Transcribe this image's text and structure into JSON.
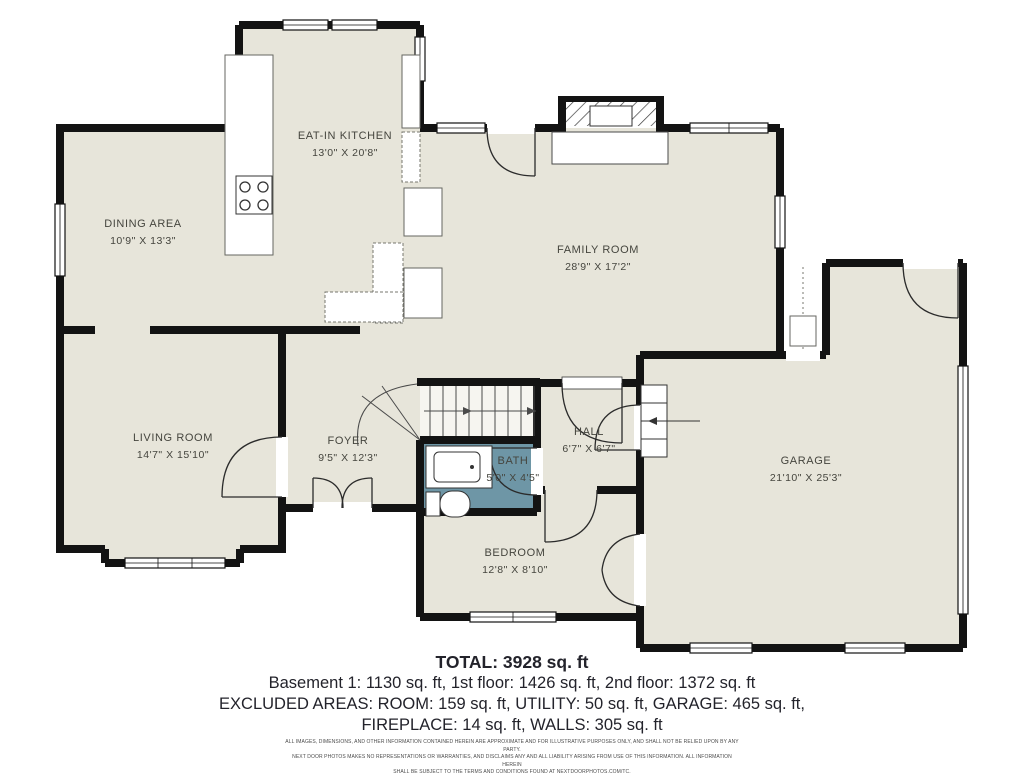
{
  "floor_plan": {
    "colors": {
      "floor": "#e7e5da",
      "wall": "#131313",
      "bath_highlight": "#6e96a6"
    },
    "rooms": [
      {
        "name": "EAT-IN KITCHEN",
        "dims": "13'0\" X 20'8\""
      },
      {
        "name": "DINING AREA",
        "dims": "10'9\" X 13'3\""
      },
      {
        "name": "FAMILY ROOM",
        "dims": "28'9\" X 17'2\""
      },
      {
        "name": "LIVING ROOM",
        "dims": "14'7\" X 15'10\""
      },
      {
        "name": "FOYER",
        "dims": "9'5\" X 12'3\""
      },
      {
        "name": "HALL",
        "dims": "6'7\" X 6'7\""
      },
      {
        "name": "BATH",
        "dims": "5'0\" X 4'5\""
      },
      {
        "name": "BEDROOM",
        "dims": "12'8\" X 8'10\""
      },
      {
        "name": "GARAGE",
        "dims": "21'10\" X 25'3\""
      }
    ]
  },
  "summary": {
    "total": "TOTAL: 3928 sq. ft",
    "floors": "Basement 1: 1130 sq. ft, 1st floor: 1426 sq. ft, 2nd floor: 1372 sq. ft",
    "excluded_1": "EXCLUDED AREAS: ROOM: 159 sq. ft, UTILITY: 50 sq. ft, GARAGE: 465 sq. ft,",
    "excluded_2": "FIREPLACE: 14 sq. ft, WALLS: 305 sq. ft"
  },
  "disclaimer": {
    "line1": "ALL IMAGES, DIMENSIONS, AND OTHER INFORMATION CONTAINED HEREIN ARE APPROXIMATE AND FOR ILLUSTRATIVE PURPOSES ONLY, AND SHALL NOT BE RELIED UPON BY ANY PARTY.",
    "line2": "NEXT DOOR PHOTOS MAKES NO REPRESENTATIONS OR WARRANTIES, AND DISCLAIMS ANY AND ALL LIABILITY ARISING FROM USE OF THIS INFORMATION. ALL INFORMATION HEREIN",
    "line3": "SHALL BE SUBJECT TO THE TERMS AND CONDITIONS FOUND AT NEXTDOORPHOTOS.COM/TC."
  }
}
